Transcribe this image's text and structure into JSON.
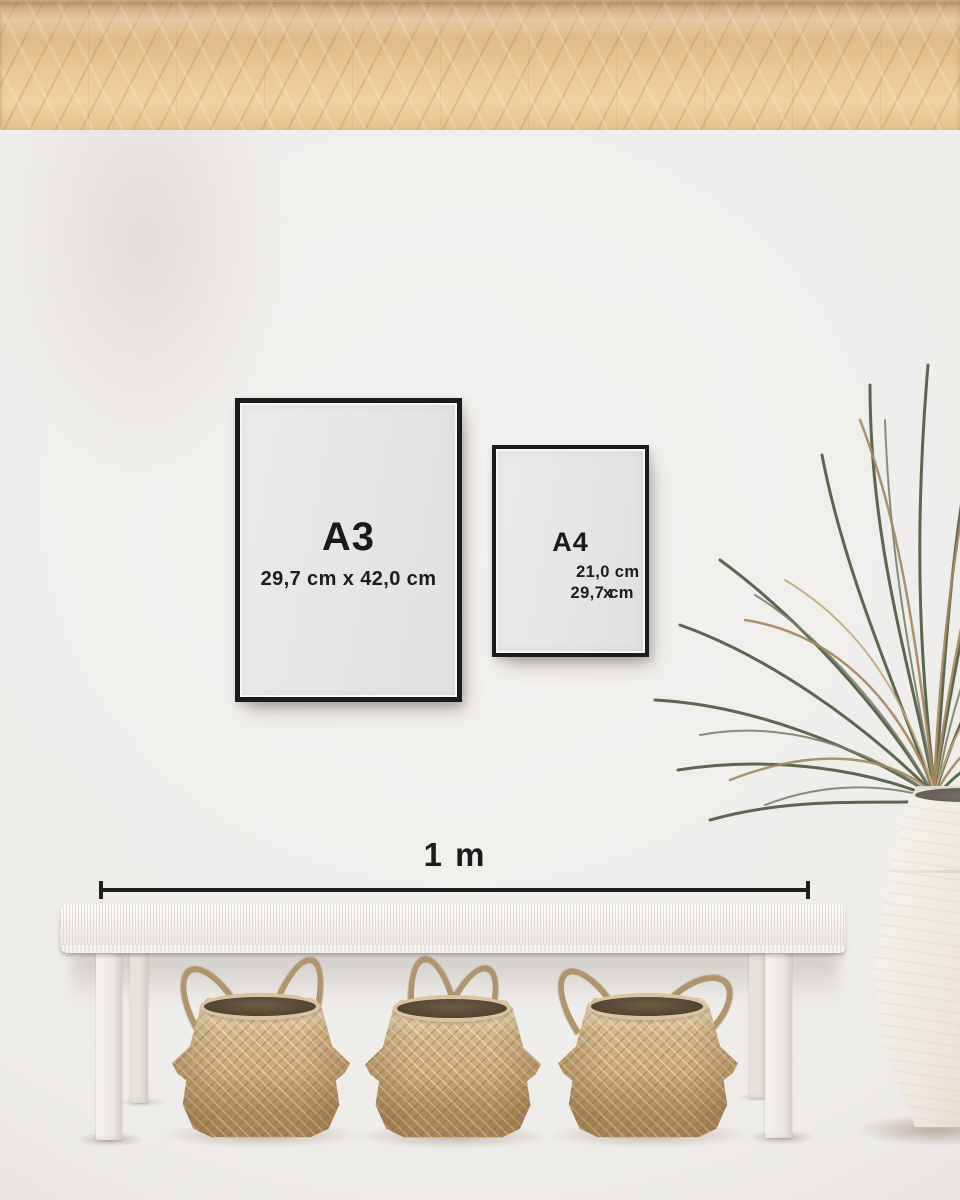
{
  "frames": [
    {
      "label": "A3",
      "dimensions": "29,7 cm x 42,0 cm"
    },
    {
      "label": "A4",
      "dimensions_line1": "21,0 cm x",
      "dimensions_line2": "29,7 cm"
    }
  ],
  "scale_bar": {
    "label": "1 m"
  },
  "colors": {
    "frame_border": "#1b1b1d",
    "text": "#1a1a1a",
    "wall": "#efedea",
    "poster_paper": "#e7e5e3",
    "floor_wood": "#dcb784",
    "basket_weave": "#cba97c",
    "bench_white": "#f4f1ed",
    "vase_ceramic": "#efe9e0",
    "plant_green": "#566048",
    "plant_dried": "#a8885f"
  }
}
